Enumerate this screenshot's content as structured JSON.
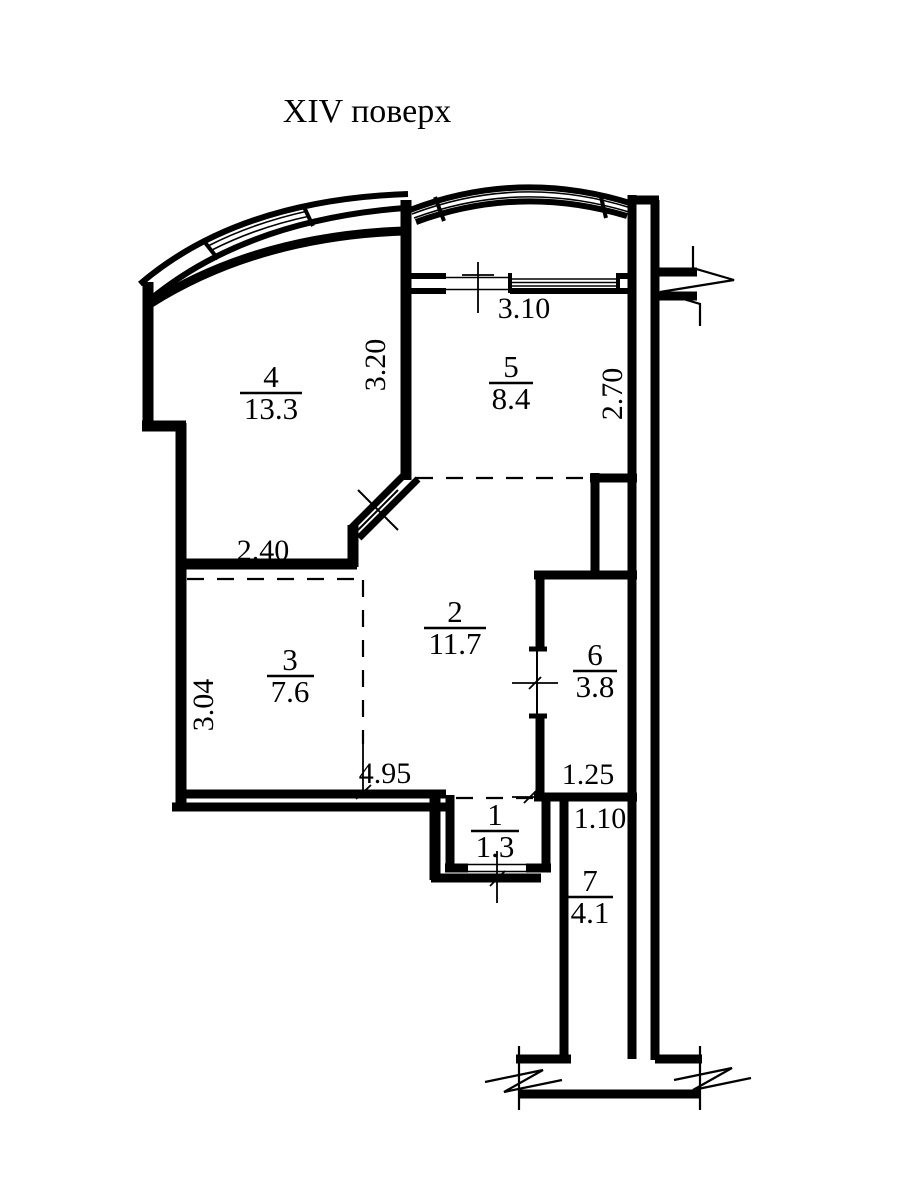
{
  "title": "XIV поверх",
  "rooms": [
    {
      "number": "4",
      "area": "13.3"
    },
    {
      "number": "5",
      "area": "8.4"
    },
    {
      "number": "2",
      "area": "11.7"
    },
    {
      "number": "3",
      "area": "7.6"
    },
    {
      "number": "6",
      "area": "3.8"
    },
    {
      "number": "1",
      "area": "1.3"
    },
    {
      "number": "7",
      "area": "4.1"
    }
  ],
  "dimensions": {
    "room5_window": "3.10",
    "room4_depth": "3.20",
    "room5_depth": "2.70",
    "room4_width": "2.40",
    "room3_depth": "3.04",
    "room3_width": "4.95",
    "room6_width": "1.25",
    "room7_width": "1.10"
  },
  "colors": {
    "line": "#000000",
    "background": "#ffffff"
  }
}
